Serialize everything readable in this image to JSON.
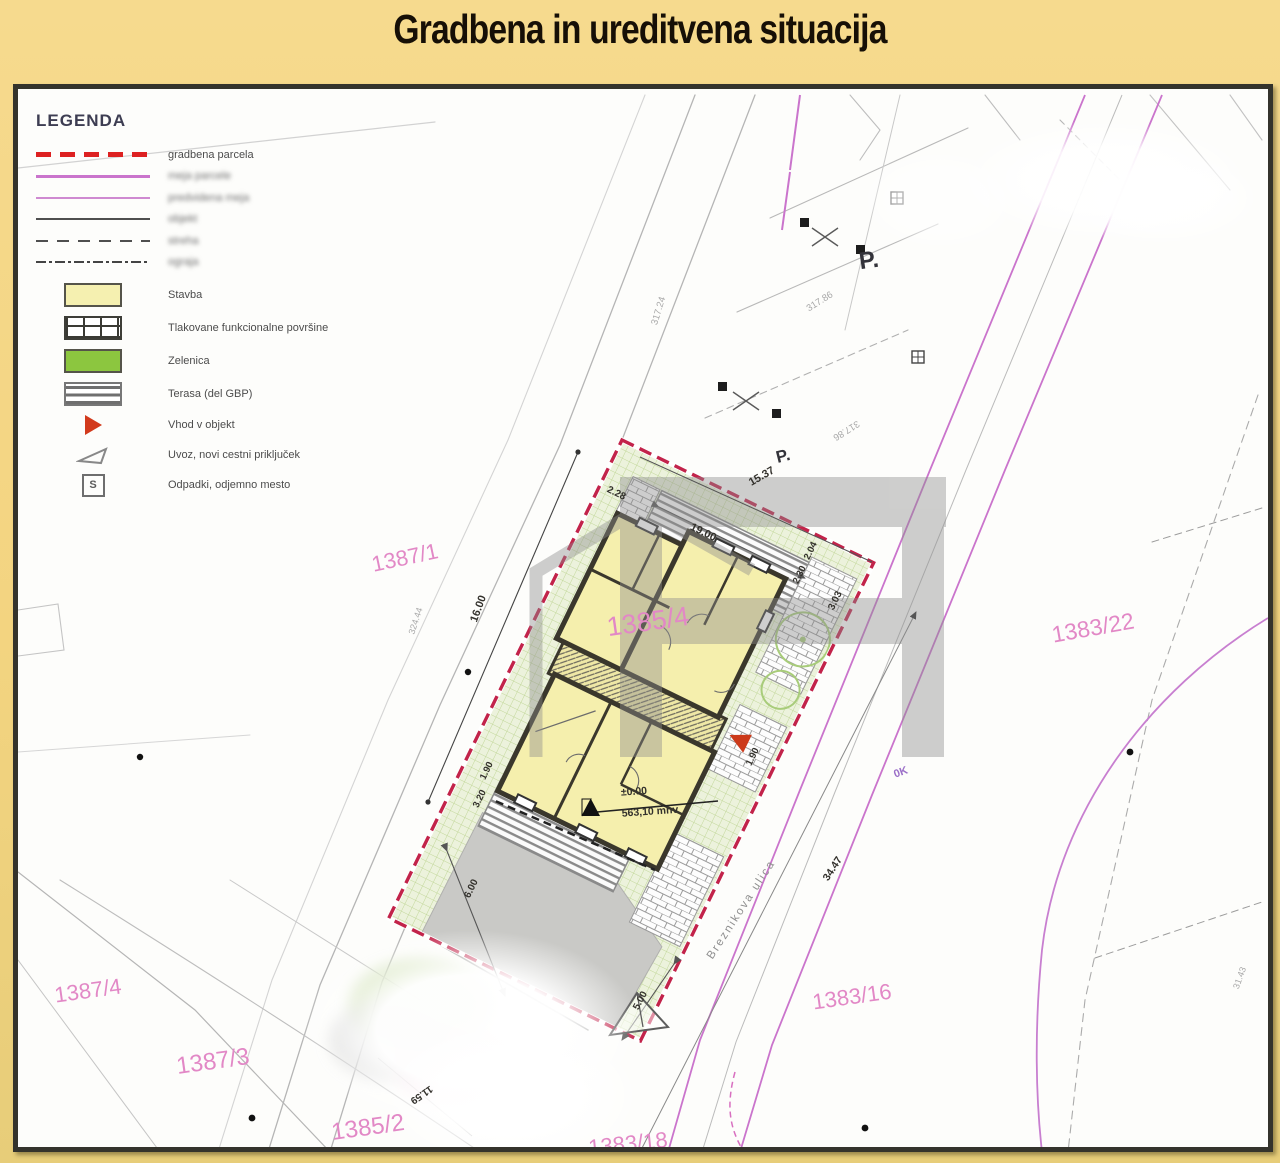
{
  "title": "Gradbena in ureditvena situacija",
  "legend": {
    "heading": "LEGENDA",
    "line_items": [
      {
        "label": "gradbena parcela",
        "blurred": false
      },
      {
        "label": "meja parcele",
        "blurred": true
      },
      {
        "label": "predvidena meja",
        "blurred": true
      },
      {
        "label": "objekt",
        "blurred": true
      },
      {
        "label": "streha",
        "blurred": true
      },
      {
        "label": "ograja",
        "blurred": true
      }
    ],
    "area_items": [
      {
        "label": "Stavba"
      },
      {
        "label": "Tlakovane funkcionalne površine"
      },
      {
        "label": "Zelenica"
      },
      {
        "label": "Terasa (del GBP)"
      },
      {
        "label": "Vhod v objekt"
      },
      {
        "label": "Uvoz, novi cestni priključek"
      },
      {
        "label": "Odpadki, odjemno mesto",
        "glyph": "S"
      }
    ]
  },
  "map": {
    "street_name": "Breznikova ulica",
    "elevation": {
      "level": "±0.00",
      "altitude": "563,10 mnv"
    },
    "parcel_numbers": [
      "1387/1",
      "1385/4",
      "1383/22",
      "1387/4",
      "1387/3",
      "1385/2",
      "1383/16",
      "1383/18"
    ],
    "labels": [
      {
        "n": "parcel-label-1387-1",
        "t": "1387/1",
        "x": 405,
        "y": 558,
        "s": 22,
        "r": -12,
        "c": "pink"
      },
      {
        "n": "parcel-label-1385-4",
        "t": "1385/4",
        "x": 648,
        "y": 622,
        "s": 27,
        "r": -8,
        "c": "pink"
      },
      {
        "n": "parcel-label-1383-22",
        "t": "1383/22",
        "x": 1093,
        "y": 628,
        "s": 23,
        "r": -10,
        "c": "pink"
      },
      {
        "n": "parcel-label-1387-4",
        "t": "1387/4",
        "x": 88,
        "y": 991,
        "s": 22,
        "r": -8,
        "c": "pink"
      },
      {
        "n": "parcel-label-1387-3",
        "t": "1387/3",
        "x": 213,
        "y": 1062,
        "s": 24,
        "r": -8,
        "c": "pink"
      },
      {
        "n": "parcel-label-1385-2",
        "t": "1385/2",
        "x": 368,
        "y": 1128,
        "s": 24,
        "r": -8,
        "c": "pink"
      },
      {
        "n": "parcel-label-1383-16",
        "t": "1383/16",
        "x": 852,
        "y": 997,
        "s": 22,
        "r": -8,
        "c": "pink"
      },
      {
        "n": "parcel-label-1383-18",
        "t": "1383/18",
        "x": 628,
        "y": 1144,
        "s": 22,
        "r": -6,
        "c": "pink"
      },
      {
        "n": "dim-15-37",
        "t": "15.37",
        "x": 762,
        "y": 477,
        "s": 11,
        "r": -30,
        "c": "dim"
      },
      {
        "n": "dim-19-00",
        "t": "19.00",
        "x": 703,
        "y": 533,
        "s": 11,
        "r": 26,
        "c": "dim"
      },
      {
        "n": "dim-2-28",
        "t": "2.28",
        "x": 616,
        "y": 494,
        "s": 10,
        "r": 26,
        "c": "dim"
      },
      {
        "n": "dim-2-04",
        "t": "2.04",
        "x": 811,
        "y": 551,
        "s": 9.5,
        "r": -64,
        "c": "dim"
      },
      {
        "n": "dim-2-30",
        "t": "2.30",
        "x": 800,
        "y": 575,
        "s": 9.5,
        "r": -64,
        "c": "dim"
      },
      {
        "n": "dim-3-03",
        "t": "3.03",
        "x": 836,
        "y": 601,
        "s": 10,
        "r": -64,
        "c": "dim"
      },
      {
        "n": "dim-1-90-right",
        "t": "1.90",
        "x": 753,
        "y": 757,
        "s": 9.5,
        "r": -64,
        "c": "dim"
      },
      {
        "n": "dim-1-90-left",
        "t": "1.90",
        "x": 487,
        "y": 771,
        "s": 9.5,
        "r": -64,
        "c": "dim"
      },
      {
        "n": "dim-3-20",
        "t": "3.20",
        "x": 480,
        "y": 799,
        "s": 9.5,
        "r": -64,
        "c": "dim"
      },
      {
        "n": "dim-6-00",
        "t": "6.00",
        "x": 472,
        "y": 889,
        "s": 10,
        "r": -64,
        "c": "dim"
      },
      {
        "n": "dim-5-00",
        "t": "5.00",
        "x": 641,
        "y": 1001,
        "s": 10,
        "r": -62,
        "c": "dim"
      },
      {
        "n": "dim-34-47",
        "t": "34.47",
        "x": 833,
        "y": 869,
        "s": 10.5,
        "r": -57,
        "c": "dim"
      },
      {
        "n": "dim-11-59",
        "t": "11.59",
        "x": 421,
        "y": 1094,
        "s": 10,
        "r": 145,
        "c": "dim"
      },
      {
        "n": "dim-16-00",
        "t": "16.00",
        "x": 479,
        "y": 609,
        "s": 11,
        "r": -70,
        "c": "dim"
      },
      {
        "n": "survey-317-24",
        "t": "317.24",
        "x": 659,
        "y": 311,
        "s": 9.5,
        "r": -73,
        "c": "faint"
      },
      {
        "n": "survey-317-86-a",
        "t": "317.86",
        "x": 820,
        "y": 302,
        "s": 9.5,
        "r": -32,
        "c": "faint"
      },
      {
        "n": "survey-317-86-b",
        "t": "317.86",
        "x": 846,
        "y": 430,
        "s": 9.5,
        "r": 148,
        "c": "faint"
      },
      {
        "n": "survey-324-44",
        "t": "324.44",
        "x": 416,
        "y": 621,
        "s": 9,
        "r": -72,
        "c": "faint"
      },
      {
        "n": "survey-31-43",
        "t": "31.43",
        "x": 1240,
        "y": 978,
        "s": 9,
        "r": -70,
        "c": "faint"
      },
      {
        "n": "parking-label-1",
        "t": "P.",
        "x": 869,
        "y": 261,
        "s": 24,
        "r": -8,
        "c": "dark",
        "w": 700
      },
      {
        "n": "parking-label-2",
        "t": "P.",
        "x": 783,
        "y": 456,
        "s": 17,
        "r": -14,
        "c": "dark",
        "w": 700
      },
      {
        "n": "street-name-label",
        "t": "Breznikova ulica",
        "x": 742,
        "y": 910,
        "s": 11.5,
        "r": -57,
        "c": "street",
        "ls": 2
      },
      {
        "n": "elevation-level",
        "t": "±0.00",
        "x": 634,
        "y": 792,
        "s": 10.5,
        "r": -4,
        "c": "dim"
      },
      {
        "n": "elevation-altitude",
        "t": "563,10 mnv",
        "x": 650,
        "y": 812,
        "s": 10.5,
        "r": -4,
        "c": "dim"
      },
      {
        "n": "marker-0k",
        "t": "0K",
        "x": 901,
        "y": 773,
        "s": 11,
        "r": -20,
        "c": "purple"
      }
    ]
  },
  "colors": {
    "background": "#f3d480",
    "panel_border": "#34332c",
    "parcel_boundary_red": "#c2234a",
    "legend_red": "#dd2121",
    "magenta_line": "#ca74cc",
    "pink_label": "#e288c6",
    "building_fill": "#f5efad",
    "green_fill": "#8cc63f",
    "green_hatch_bg": "#ecf2dc",
    "driveway_gray": "#c9c9c6",
    "entrance_red": "#cc3a1a",
    "watermark_gray": "#8d8d8d"
  }
}
